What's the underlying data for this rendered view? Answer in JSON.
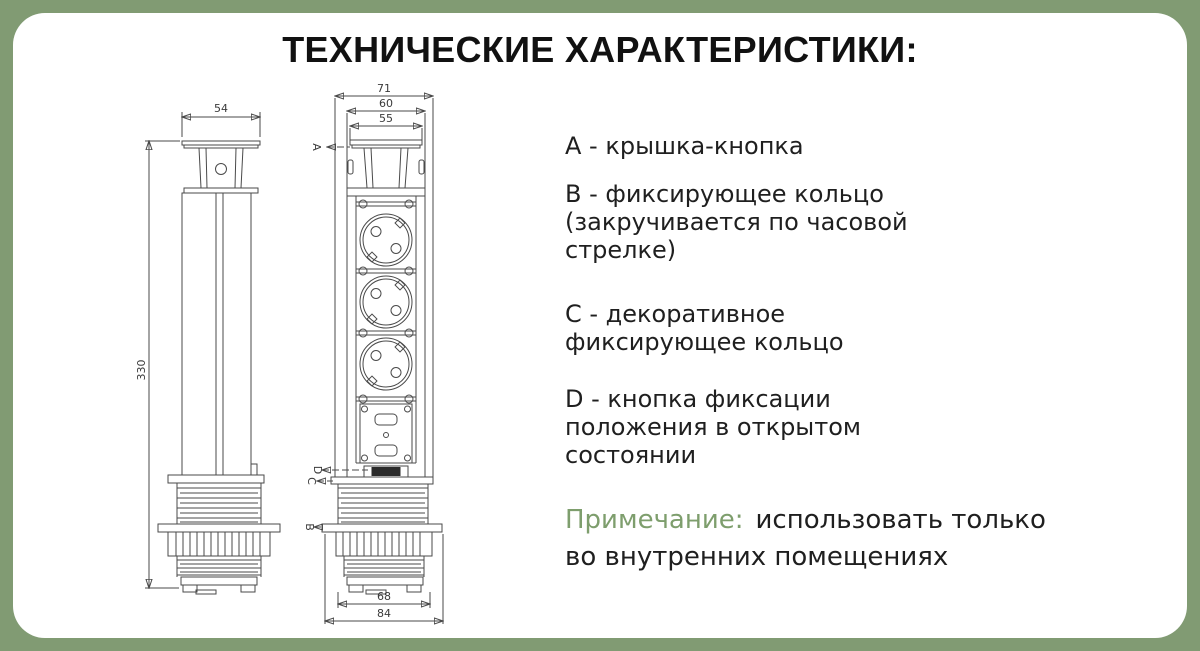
{
  "title": "ТЕХНИЧЕСКИЕ ХАРАКТЕРИСТИКИ:",
  "specs": [
    {
      "id": "A",
      "lines": [
        "А - крышка-кнопка"
      ]
    },
    {
      "id": "B",
      "lines": [
        "В - фиксирующее кольцо",
        "(закручивается по часовой",
        "стрелке)"
      ]
    },
    {
      "id": "C",
      "lines": [
        "С - декоративное",
        "фиксирующее кольцо"
      ]
    },
    {
      "id": "D",
      "lines": [
        "D - кнопка фиксации",
        "положения в открытом",
        "состоянии"
      ]
    }
  ],
  "note": {
    "label": "Примечание:",
    "line1": "использовать только",
    "line2": "во внутренних помещениях"
  },
  "drawing": {
    "side_view": {
      "top_dim": "54",
      "height_dim": "330"
    },
    "front_view": {
      "top_dims": [
        "71",
        "60",
        "55"
      ],
      "bottom_dims": [
        "68",
        "84"
      ],
      "labels": {
        "a": "A",
        "b": "B",
        "c": "C",
        "d": "D"
      }
    }
  },
  "colors": {
    "background": "#819b73",
    "card": "#ffffff",
    "heading_text": "#111111",
    "body_text": "#1f1f1f",
    "note_label": "#7e9e6d",
    "drawing_line": "#4a4a4a",
    "button_fill": "#2b2b2b"
  }
}
